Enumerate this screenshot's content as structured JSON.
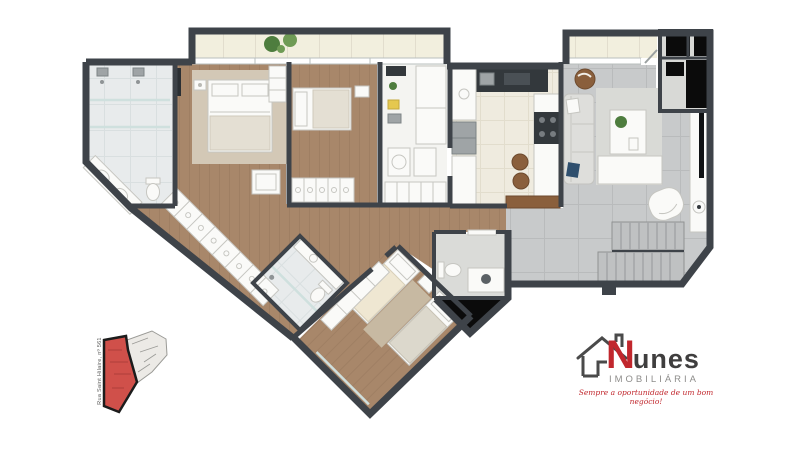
{
  "logo": {
    "brand_initial": "N",
    "brand_rest": "unes",
    "subtitle": "IMOBILIÁRIA",
    "tagline": "Sempre a oportunidade de um bom negócio!"
  },
  "inset": {
    "street_label": "Rua Saint Hilaire, nº 561"
  },
  "colors": {
    "wall": "#3e4349",
    "wood": "#a8876a",
    "wood_line": "#97775c",
    "marble": "#e8ebec",
    "marble_line": "#d9dfe0",
    "tile": "#c8cacb",
    "tile_line": "#b9bbbc",
    "cream": "#efebdf",
    "cream_line": "#e2ddcd",
    "balcony": "#f2efde",
    "white_floor": "#f4f4f1",
    "lavabo_floor": "#dadbd8",
    "shaft": "#0b0b0b",
    "furniture_white": "#fafaf8",
    "furniture_stroke": "#c6c6c1",
    "sofa": "#dededb",
    "rug_living": "#d9dad6",
    "rug_beige": "#d3c8b6",
    "rug_tan": "#c7b9a2",
    "navy": "#2f4f6e",
    "brown": "#8a5f3c",
    "green": "#4e7d3e",
    "stainless": "#9fa4a6",
    "dark_counter": "#33383c",
    "steps": "#bfc1c2",
    "step_line": "#a4a6a7",
    "glass": "#cfe0de",
    "brand_red": "#c1272d",
    "brand_dark": "#3f3e3e",
    "brand_gray": "#8e8d8b",
    "inset_red": "#d0504a",
    "inset_red_line": "#8f2f2c",
    "inset_gray": "#eceae6",
    "inset_line": "#9a9a96"
  }
}
